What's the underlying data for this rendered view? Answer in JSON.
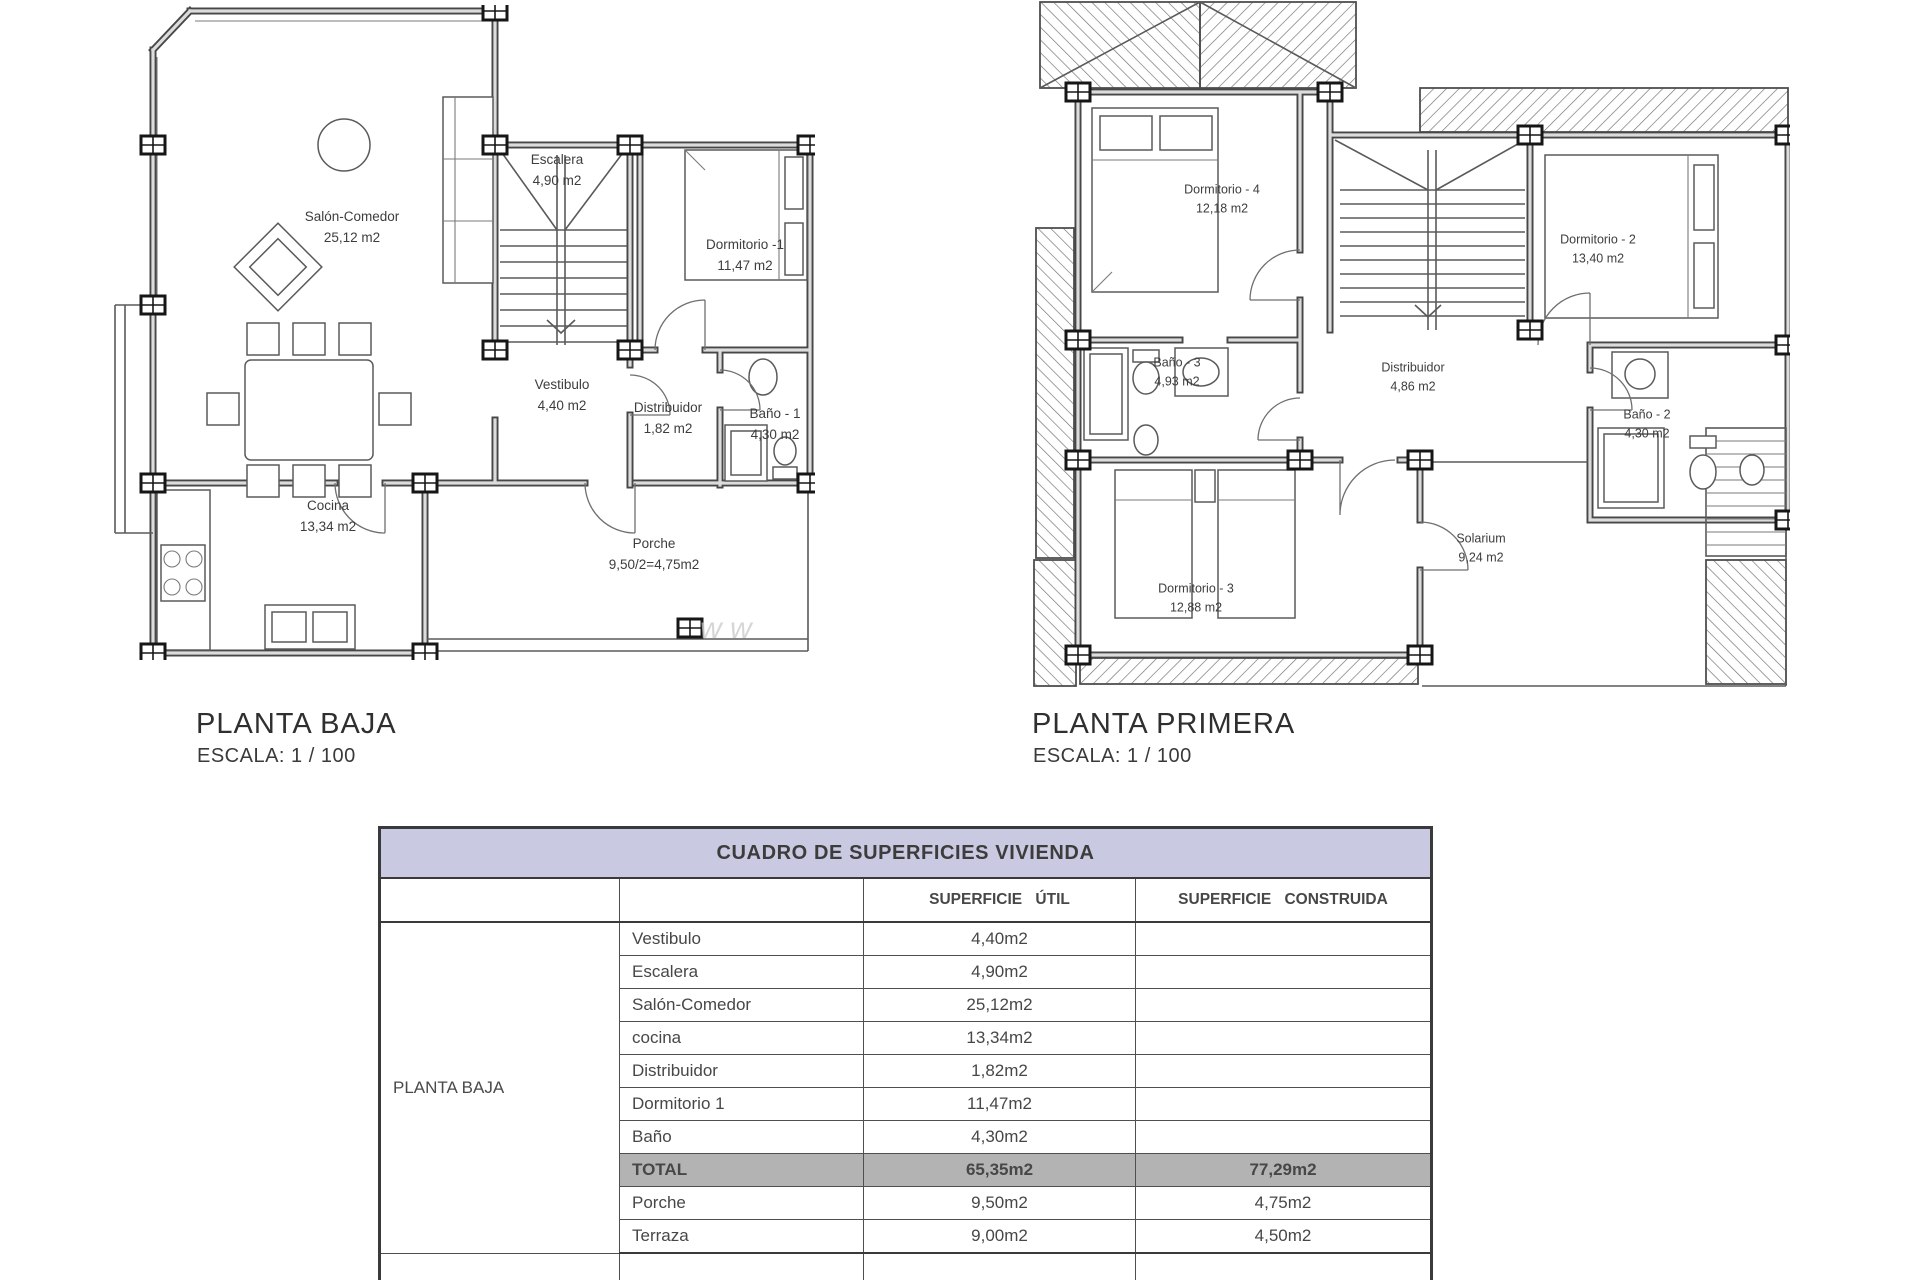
{
  "sheet": {
    "watermark": "w w"
  },
  "floor_plans": {
    "planta_baja": {
      "title": "PLANTA BAJA",
      "scale": "ESCALA: 1 / 100",
      "rooms": [
        {
          "name": "Salón-Comedor",
          "area": "25,12 m2"
        },
        {
          "name": "Escalera",
          "area": "4,90 m2"
        },
        {
          "name": "Dormitorio -1",
          "area": "11,47 m2"
        },
        {
          "name": "Vestibulo",
          "area": "4,40 m2"
        },
        {
          "name": "Distribuidor",
          "area": "1,82 m2"
        },
        {
          "name": "Baño - 1",
          "area": "4,30 m2"
        },
        {
          "name": "Cocina",
          "area": "13,34 m2"
        },
        {
          "name": "Porche",
          "area": "9,50/2=4,75m2"
        }
      ]
    },
    "planta_primera": {
      "title": "PLANTA PRIMERA",
      "scale": "ESCALA: 1 / 100",
      "rooms": [
        {
          "name": "Dormitorio - 4",
          "area": "12,18 m2"
        },
        {
          "name": "Dormitorio - 2",
          "area": "13,40 m2"
        },
        {
          "name": "Baño - 3",
          "area": "4,93 m2"
        },
        {
          "name": "Distribuidor",
          "area": "4,86 m2"
        },
        {
          "name": "Baño - 2",
          "area": "4,30 m2"
        },
        {
          "name": "Dormitorio - 3",
          "area": "12,88 m2"
        },
        {
          "name": "Solarium",
          "area": "9,24 m2"
        }
      ]
    }
  },
  "table": {
    "title": "CUADRO DE SUPERFICIES  VIVIENDA",
    "col_util": "SUPERFICIE ÚTIL",
    "col_construida": "SUPERFICIE CONSTRUIDA",
    "section": "PLANTA BAJA",
    "rows": [
      {
        "room": "Vestibulo",
        "util": "4,40m2",
        "construida": ""
      },
      {
        "room": "Escalera",
        "util": "4,90m2",
        "construida": ""
      },
      {
        "room": "Salón-Comedor",
        "util": "25,12m2",
        "construida": ""
      },
      {
        "room": "cocina",
        "util": "13,34m2",
        "construida": ""
      },
      {
        "room": "Distribuidor",
        "util": "1,82m2",
        "construida": ""
      },
      {
        "room": "Dormitorio 1",
        "util": "11,47m2",
        "construida": ""
      },
      {
        "room": "Baño",
        "util": "4,30m2",
        "construida": ""
      },
      {
        "room": "TOTAL",
        "util": "65,35m2",
        "construida": "77,29m2"
      },
      {
        "room": "Porche",
        "util": "9,50m2",
        "construida": "4,75m2"
      },
      {
        "room": "Terraza",
        "util": "9,00m2",
        "construida": "4,50m2"
      }
    ],
    "colors": {
      "header_bg": "#c9c9e1",
      "total_bg": "#b3b3b3"
    }
  }
}
